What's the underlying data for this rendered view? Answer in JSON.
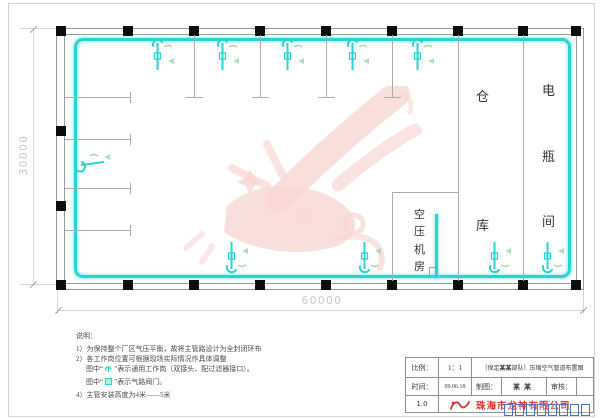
{
  "plan": {
    "dim_left": "30000",
    "dim_bottom": "60000",
    "rooms": {
      "warehouse": "仓库",
      "battery": "电瓶间",
      "compressor": "空压机房"
    },
    "columns_top_x": [
      61,
      128,
      194,
      260,
      326,
      392,
      458,
      523,
      576
    ],
    "columns_bottom_x": [
      61,
      128,
      194,
      260,
      326,
      392,
      458,
      523,
      576
    ],
    "columns_left_y": [
      131,
      206
    ],
    "stubs_top_x": [
      194,
      260,
      326,
      392
    ],
    "stubs_left_y": [
      97,
      139,
      188,
      230
    ],
    "partitions_x": [
      458,
      523
    ],
    "stations_top_x": [
      158,
      223,
      288,
      353,
      418
    ],
    "stations_bottom_x": [
      232,
      365,
      495,
      548
    ]
  },
  "notes": {
    "heading": "说明：",
    "line1": "1）为保持整个厂区气压平衡，故将主管路设计为全封闭环布",
    "line2": "2）各工作岗位置可根据现场实际情况作具体调整",
    "line3_prefix": "图中“",
    "line3_suffix": "”表示通用工作岗（双接头、配过滤器接口）。",
    "line4_prefix": "图中“",
    "line4_suffix": "”表示气路阀门。",
    "line5": "4）主管安装高度为4米——5米"
  },
  "titleblock": {
    "scale_label": "比例：",
    "scale_value": "1：1",
    "title_prefix": "（保定 ",
    "title_name": "某某",
    "title_suffix": " 部队）压缩空气管道布置图",
    "date_label": "时间：",
    "date_value": "09.06.18",
    "drafter_label": "制图：",
    "drafter_name": "某某",
    "reviewer_label": "审核：",
    "reviewer_value": "",
    "version": "1.0",
    "company_name": "珠海市龙神有限公司",
    "missing_glyph_box_count": 8
  },
  "colors": {
    "pipe": "#29d3d3",
    "pipe_glow": "#aeeaea",
    "tag_green": "#9fd8b3",
    "company_red": "#d9342f",
    "watermark_pink": "#ef9d96",
    "tofu_blue": "#4d6fc9",
    "dim_gray": "#c9c9c9"
  }
}
